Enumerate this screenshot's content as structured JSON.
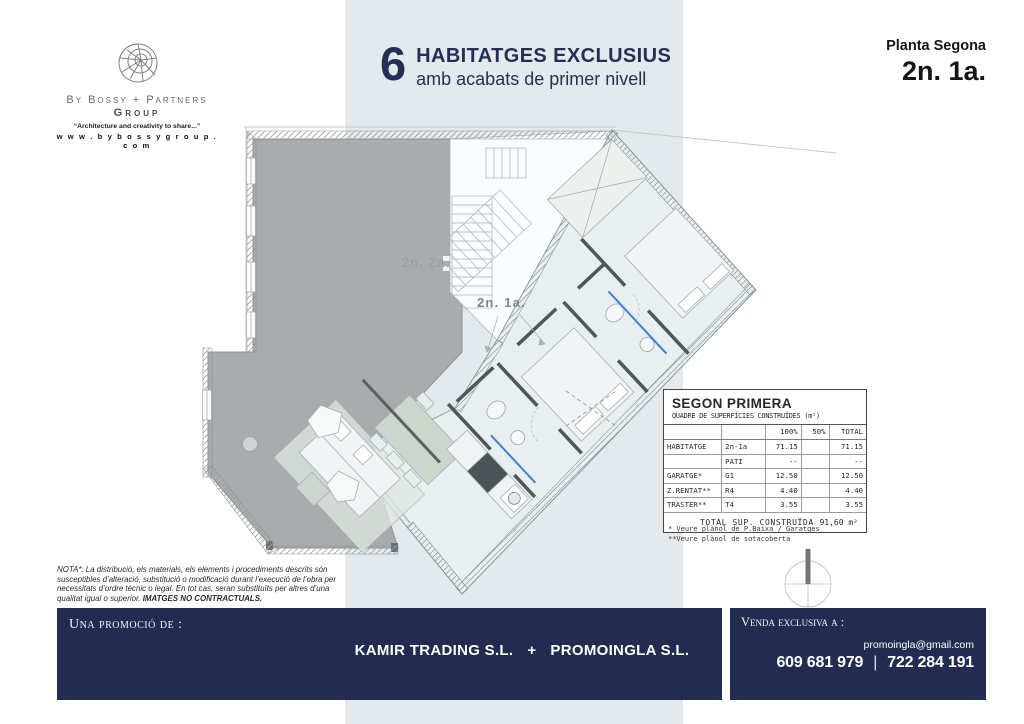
{
  "logo": {
    "brand": "By Bossy + Partners",
    "group": "Group",
    "tagline": "“Architecture and creativity to share...”",
    "website": "w w w . b y b o s s y g r o u p . c o m"
  },
  "header": {
    "big_number": "6",
    "title": "HABITATGES EXCLUSIUS",
    "subtitle": "amb acabats de primer nivell"
  },
  "plan_ref": {
    "floor": "Planta Segona",
    "unit": "2n. 1a."
  },
  "floorplan": {
    "unit_left_label": "2n. 2a.",
    "unit_right_label": "2n. 1a."
  },
  "surface_table": {
    "title": "SEGON PRIMERA",
    "subtitle": "QUADRE DE SUPERFÍCIES CONSTRUÏDES (m²)",
    "col_100": "100%",
    "col_50": "50%",
    "col_total": "TOTAL",
    "rows": [
      {
        "category": "HABITATGE",
        "code": "2n-1a",
        "p100": "71.15",
        "p50": "",
        "total": "71.15"
      },
      {
        "category": "",
        "code": "PATI",
        "p100": "--",
        "p50": "",
        "total": "--"
      },
      {
        "category": "GARATGE*",
        "code": "G1",
        "p100": "12.50",
        "p50": "",
        "total": "12.50"
      },
      {
        "category": "Z.RENTAT**",
        "code": "R4",
        "p100": "4.40",
        "p50": "",
        "total": "4.40"
      },
      {
        "category": "TRASTER**",
        "code": "T4",
        "p100": "3.55",
        "p50": "",
        "total": "3.55"
      }
    ],
    "total_label": "TOTAL SUP. CONSTRUÏDA",
    "total_value": "91,60 m²",
    "footnote1": "* Veure plànol de P.Baixa / Garatges",
    "footnote2": "**Veure plànol de sotacoberta"
  },
  "nota": {
    "text": "NOTA*: La distribució, els materials, els elements i procediments descrits són susceptibles d’alteració, substitució o modificació durant l’execució de l’obra per necessitats d’ordre tècnic o legal. En tot cas, seran substituïts per altres d’una qualitat igual o superior. ",
    "bold": "IMATGES NO CONTRACTUALS."
  },
  "footer": {
    "promo_label": "Una promoció de :",
    "company_left": "KAMIR TRADING S.L.",
    "plus": "+",
    "company_right": "PROMOINGLA S.L.",
    "sales_label": "Venda exclusiva a :",
    "email": "promoingla@gmail.com",
    "phone_1": "609 681 979",
    "phone_sep": "|",
    "phone_2": "722 284 191"
  },
  "colors": {
    "navy": "#222c50",
    "band": "#e3e9ec",
    "accent_blue": "#3d7fd9",
    "unit_gray": "#a9abac"
  }
}
